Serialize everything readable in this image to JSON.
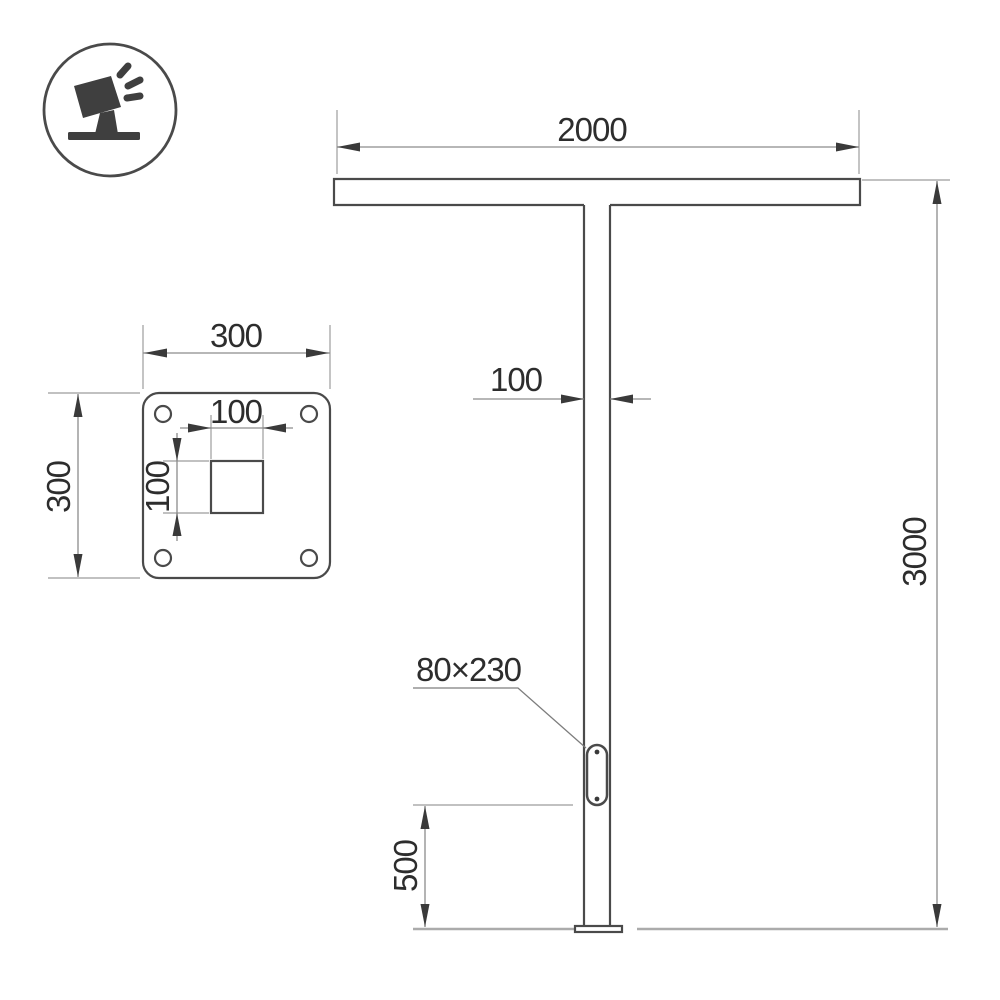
{
  "page": {
    "background": "#ffffff",
    "description": "Technical dimension drawing of a T-shaped street/park light pole with service opening and base plate detail"
  },
  "colors": {
    "outline": "#4a4a4a",
    "dimension_line": "#8c8c8c",
    "extension_line": "#9c9c9c",
    "ground_line": "#ababab",
    "arrow": "#3a3a3a",
    "text": "#2d2d2d",
    "icon": "#3f3f3f"
  },
  "icon": {
    "name": "tilted-floodlight-luminaire-icon"
  },
  "dims": {
    "crossbar_width": "2000",
    "pole_width": "100",
    "pole_height": "3000",
    "service_opening": "80×230",
    "opening_height": "500",
    "plate_width": "300",
    "plate_height": "300",
    "square_hole_width": "100",
    "square_hole_height": "100"
  }
}
